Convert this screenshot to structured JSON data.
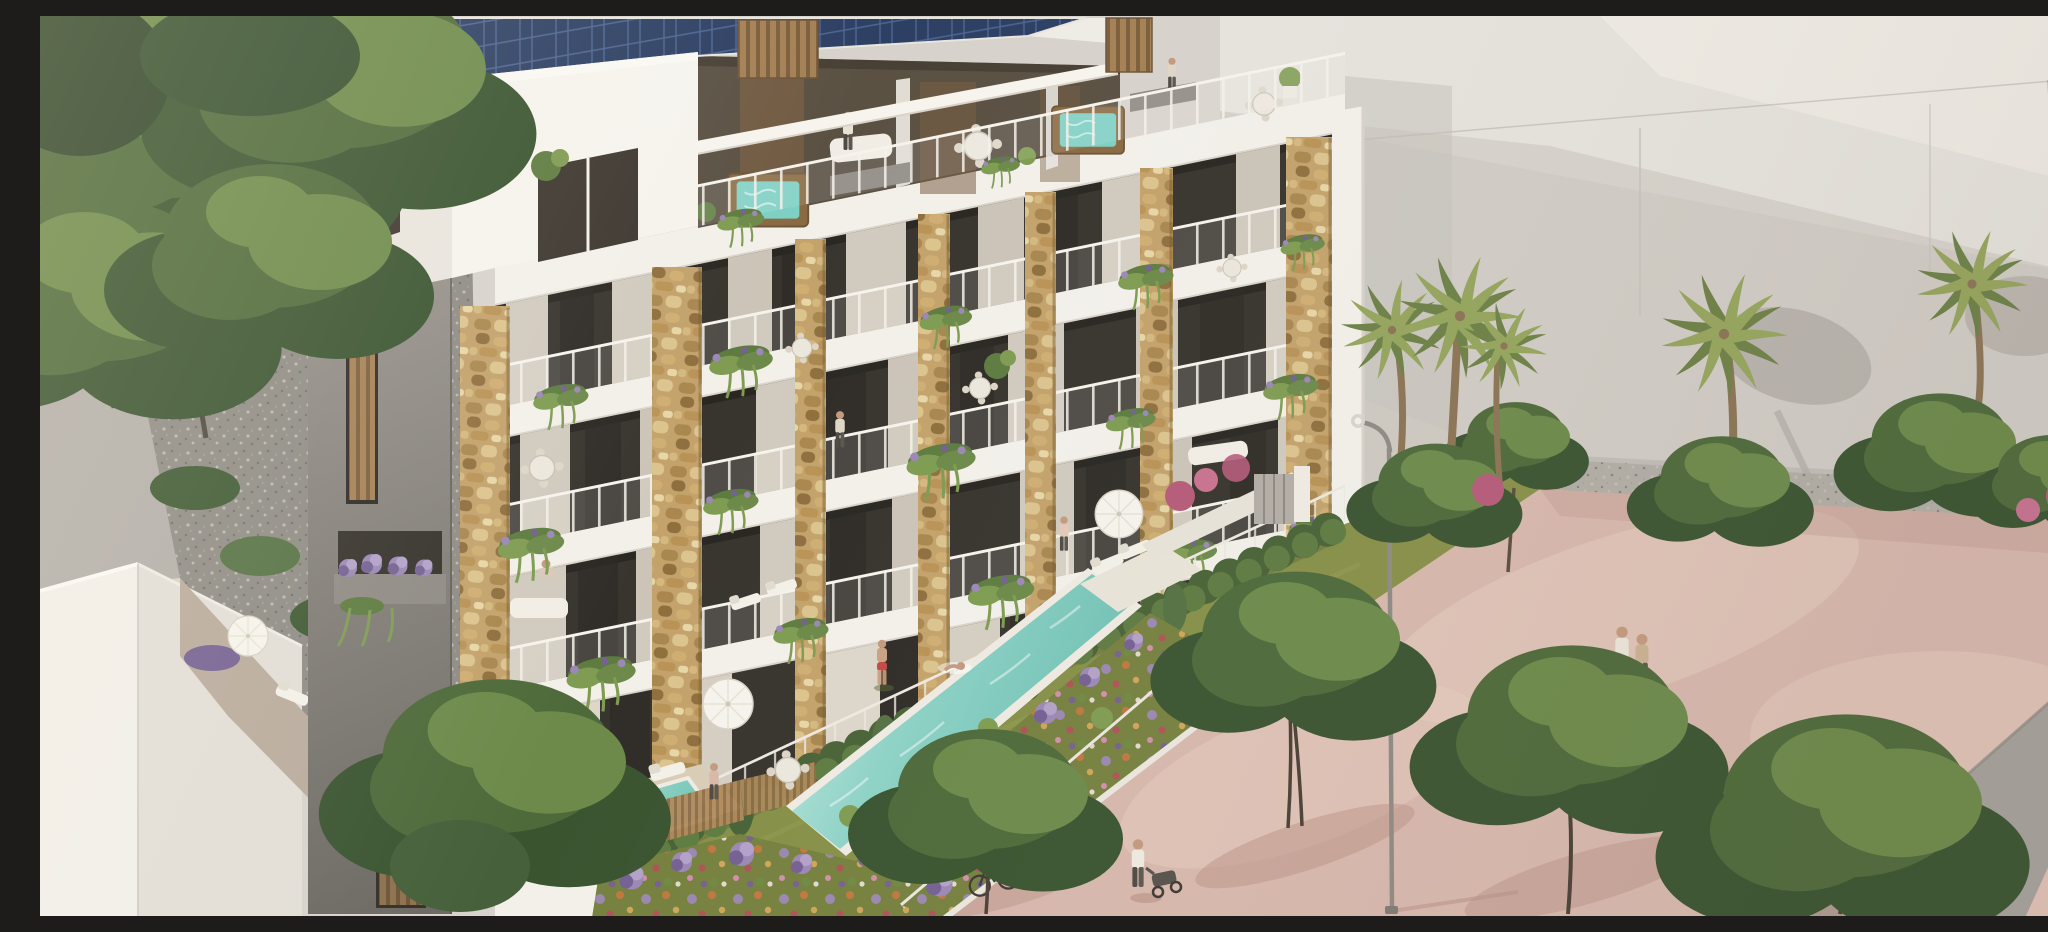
{
  "scene": {
    "description": "Aerial architectural rendering of a modern apartment building in warm late-day light: rooftop solar panels, penthouse terraces with wooden hot tubs and dining sets, four floors of balconies framed by white slabs and golden rubble-stone pillars with hanging plants, a hedge-lined podium garden with lawn, a long turquoise lap pool with a swimmer, a small plunge pool, terraced flower beds full of lavender and colourful blooms, and a pink pedestrian promenade with leafy trees, palm trees, curved street lamps, a strolling couple, a person pushing a stroller, parked bicycles and a grey road in the lower-right corner; pale neighbouring buildings and dark trees frame the scene",
    "visible_elements": [
      "solar panel array on roof",
      "rooftop jacuzzi terraces",
      "stone-clad balcony facade",
      "hanging balcony plants",
      "lap pool with swimmer",
      "plunge pool with lounger",
      "flower terraces with lavender",
      "pink promenade with trees and palms",
      "street lamps",
      "pedestrians and bicycles",
      "grey road corner"
    ]
  },
  "palette": {
    "bgWall": "#d7d2cb",
    "bgWallLight": "#e7e3dc",
    "bgWallBright": "#f0ece5",
    "bgWallShade": "#c7c2bb",
    "leftWall": "#b3afa9",
    "gravelYard": "#8f8c85",
    "facadeWhite": "#f3f0ea",
    "slabShade": "#d9d3ca",
    "concrete": "#95918a",
    "concreteDark": "#6c6862",
    "glass": "#38342e",
    "interiorDark": "#2c2925",
    "curtain": "#d1cabe",
    "curtainBright": "#ddd6c9",
    "stone": "#c3a26b",
    "stoneDark": "#9a7c49",
    "stoneLight": "#e4cf9e",
    "wood": "#a58055",
    "woodDark": "#6d553a",
    "solarPanel": "#2d3f63",
    "solarLine": "#4d6691",
    "poolWater": "#8ed2c6",
    "poolDeep": "#6fc0b3",
    "poolLight": "#c5eadf",
    "poolRim": "#efebe2",
    "lawn": "#879048",
    "lawnDark": "#76813f",
    "hedge": "#496337",
    "hedgeLight": "#5e7c42",
    "plant": "#5e7c40",
    "plantLight": "#7f9c52",
    "lavender": "#9c88b5",
    "lavenderDark": "#756192",
    "flowerOrange": "#c5763f",
    "flowerRed": "#b25159",
    "flowerYellow": "#d6a75a",
    "flowerPink": "#d88fb0",
    "bougainvillea": "#b65b7a",
    "treeDark": "#3a5430",
    "treeGreen": "#4e6a3a",
    "treeLight": "#6d8a4a",
    "palmGreen": "#6d8146",
    "palmLight": "#95a55c",
    "palmTrunk": "#8c7455",
    "promenade": "#d8b8ad",
    "promenadeLight": "#e7ccc0",
    "promenadeShade": "#c29c91",
    "road": "#a5a19a",
    "gravelStrip": "#b2aea6",
    "white": "#f8f6f1",
    "skin": "#c49a7e",
    "accentRed": "#c14b44"
  }
}
